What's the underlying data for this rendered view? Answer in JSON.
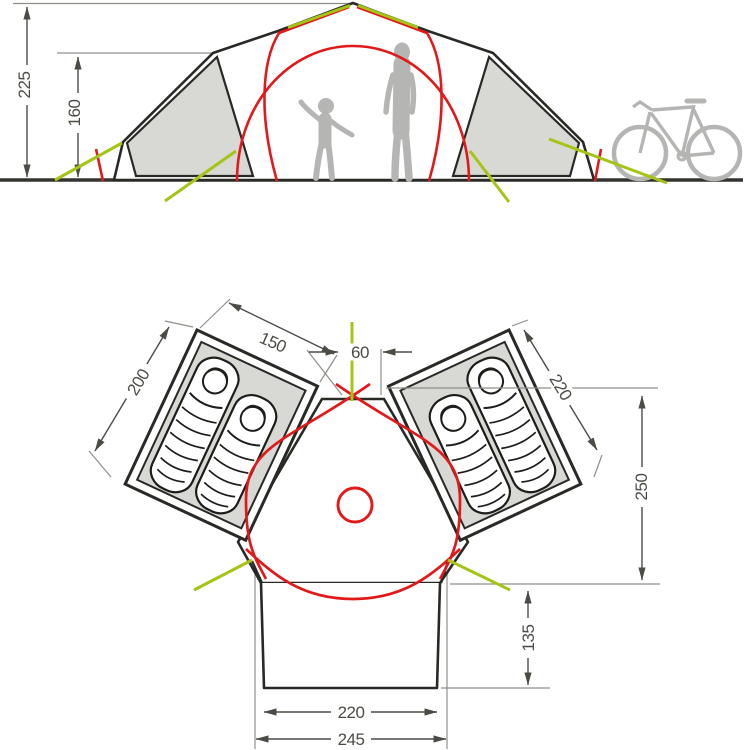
{
  "diagram": {
    "colors": {
      "outline": "#292925",
      "pole_red": "#e2191b",
      "guyline_green": "#a4c416",
      "fabric_gray": "#d8d8d4",
      "silhouette_gray": "#b5b5b3",
      "dimension_gray": "#4c4c46"
    },
    "elevation": {
      "dimensions": {
        "total_height": "225",
        "inner_height": "160"
      }
    },
    "floorplan": {
      "dimensions": {
        "cabin_width": "150",
        "center_opening": "60",
        "left_cabin_depth": "200",
        "right_cabin_depth": "220",
        "main_depth": "250",
        "porch_depth": "135",
        "porch_inner_width": "220",
        "porch_outer_width": "245"
      }
    }
  }
}
